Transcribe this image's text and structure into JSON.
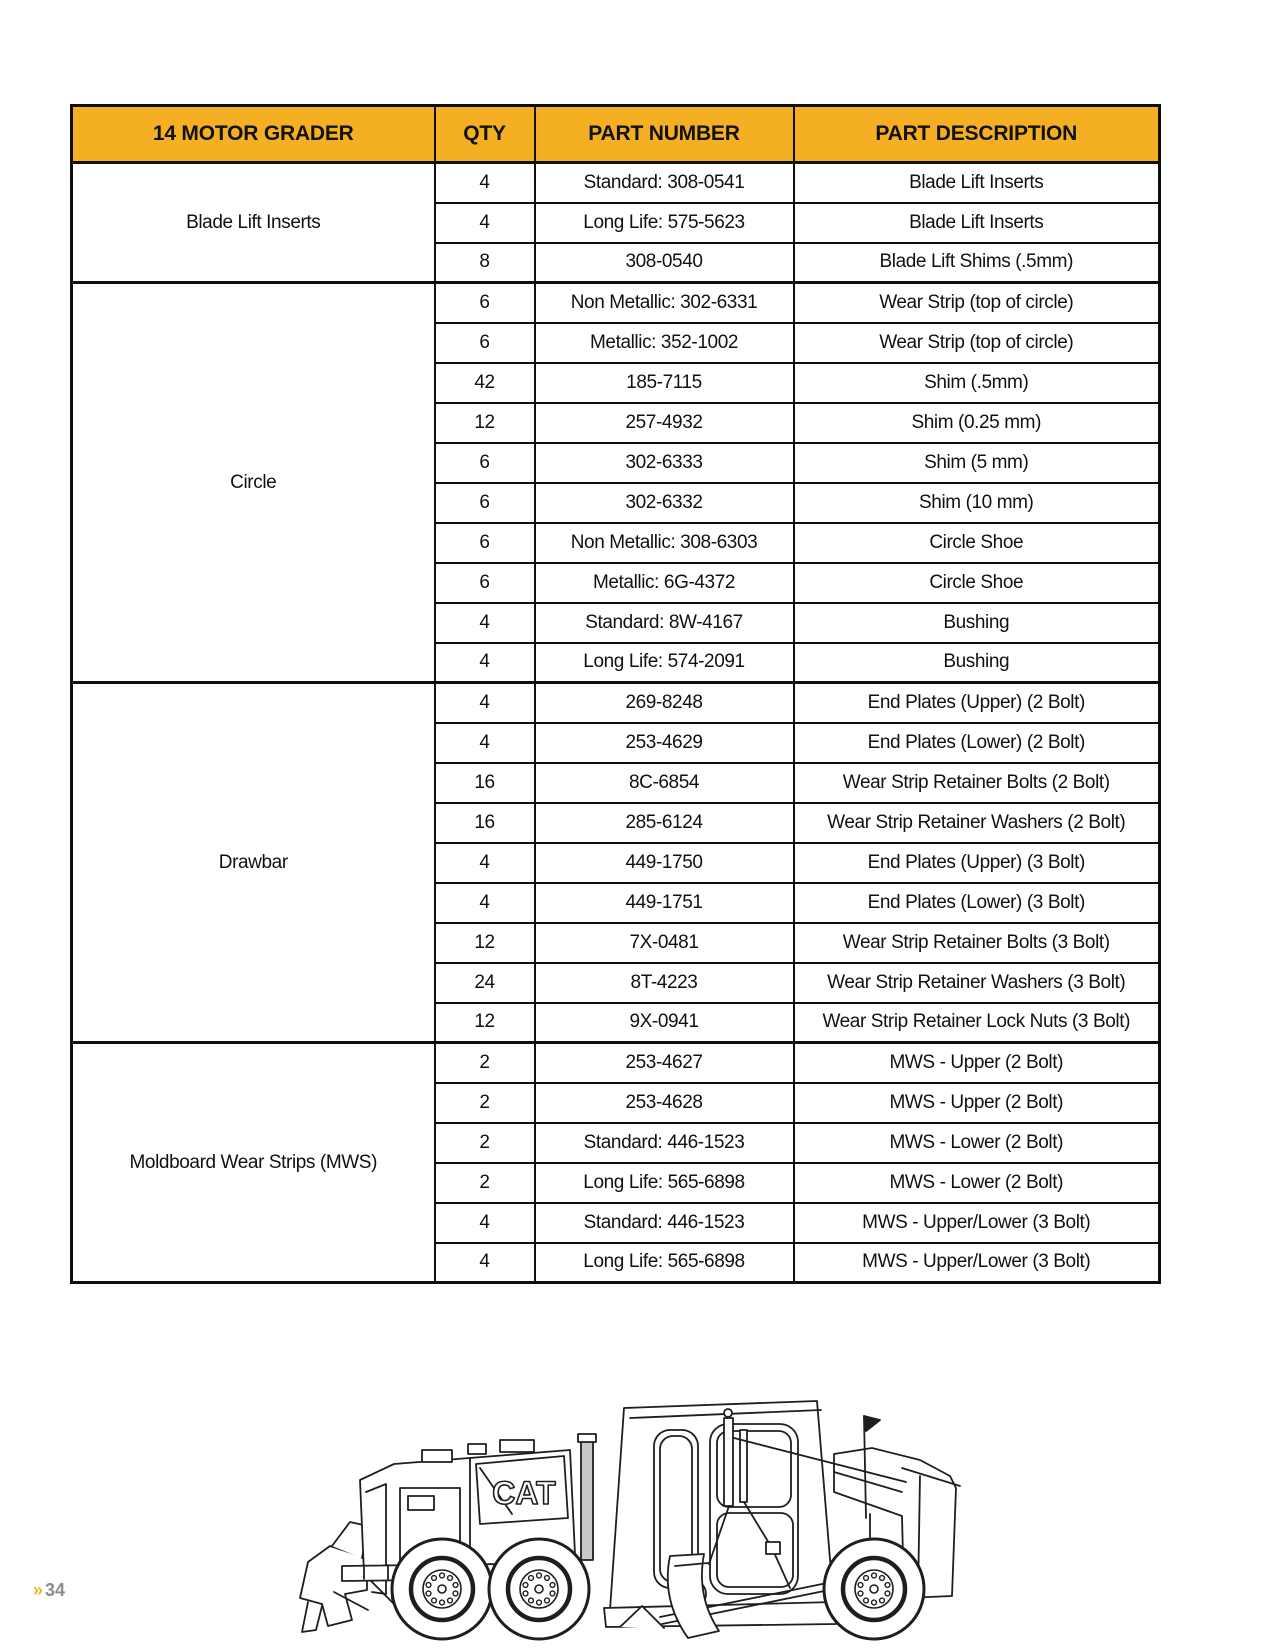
{
  "page": {
    "marker": "»",
    "number": "34"
  },
  "colors": {
    "header_bg": "#F4AF23",
    "border": "#0E0E0E",
    "marker_yellow": "#F0B429",
    "page_number_gray": "#8C8C8E"
  },
  "table": {
    "headers": [
      "14 MOTOR GRADER",
      "QTY",
      "PART NUMBER",
      "PART DESCRIPTION"
    ],
    "sections": [
      {
        "group": "Blade Lift Inserts",
        "rows": [
          {
            "qty": "4",
            "part_number": "Standard: 308-0541",
            "description": "Blade Lift Inserts"
          },
          {
            "qty": "4",
            "part_number": "Long Life: 575-5623",
            "description": "Blade Lift Inserts"
          },
          {
            "qty": "8",
            "part_number": "308-0540",
            "description": "Blade Lift Shims (.5mm)"
          }
        ]
      },
      {
        "group": "Circle",
        "rows": [
          {
            "qty": "6",
            "part_number": "Non Metallic: 302-6331",
            "description": "Wear Strip (top of circle)"
          },
          {
            "qty": "6",
            "part_number": "Metallic: 352-1002",
            "description": "Wear Strip (top of circle)"
          },
          {
            "qty": "42",
            "part_number": "185-7115",
            "description": "Shim (.5mm)"
          },
          {
            "qty": "12",
            "part_number": "257-4932",
            "description": "Shim (0.25 mm)"
          },
          {
            "qty": "6",
            "part_number": "302-6333",
            "description": "Shim (5 mm)"
          },
          {
            "qty": "6",
            "part_number": "302-6332",
            "description": "Shim (10 mm)"
          },
          {
            "qty": "6",
            "part_number": "Non Metallic: 308-6303",
            "description": "Circle Shoe"
          },
          {
            "qty": "6",
            "part_number": "Metallic: 6G-4372",
            "description": "Circle Shoe"
          },
          {
            "qty": "4",
            "part_number": "Standard: 8W-4167",
            "description": "Bushing"
          },
          {
            "qty": "4",
            "part_number": "Long Life: 574-2091",
            "description": "Bushing"
          }
        ]
      },
      {
        "group": "Drawbar",
        "rows": [
          {
            "qty": "4",
            "part_number": "269-8248",
            "description": "End Plates (Upper) (2 Bolt)"
          },
          {
            "qty": "4",
            "part_number": "253-4629",
            "description": "End Plates (Lower) (2 Bolt)"
          },
          {
            "qty": "16",
            "part_number": "8C-6854",
            "description": "Wear Strip Retainer Bolts (2 Bolt)"
          },
          {
            "qty": "16",
            "part_number": "285-6124",
            "description": "Wear Strip Retainer Washers (2 Bolt)"
          },
          {
            "qty": "4",
            "part_number": "449-1750",
            "description": "End Plates (Upper) (3 Bolt)"
          },
          {
            "qty": "4",
            "part_number": "449-1751",
            "description": "End Plates (Lower) (3 Bolt)"
          },
          {
            "qty": "12",
            "part_number": "7X-0481",
            "description": "Wear Strip Retainer Bolts (3 Bolt)"
          },
          {
            "qty": "24",
            "part_number": "8T-4223",
            "description": "Wear Strip Retainer Washers (3 Bolt)"
          },
          {
            "qty": "12",
            "part_number": "9X-0941",
            "description": "Wear Strip Retainer Lock Nuts (3 Bolt)"
          }
        ]
      },
      {
        "group": "Moldboard Wear Strips (MWS)",
        "rows": [
          {
            "qty": "2",
            "part_number": "253-4627",
            "description": "MWS - Upper (2 Bolt)"
          },
          {
            "qty": "2",
            "part_number": "253-4628",
            "description": "MWS - Upper (2 Bolt)"
          },
          {
            "qty": "2",
            "part_number": "Standard: 446-1523",
            "description": "MWS - Lower (2 Bolt)"
          },
          {
            "qty": "2",
            "part_number": "Long Life: 565-6898",
            "description": "MWS - Lower (2 Bolt)"
          },
          {
            "qty": "4",
            "part_number": "Standard: 446-1523",
            "description": "MWS - Upper/Lower (3 Bolt)"
          },
          {
            "qty": "4",
            "part_number": "Long Life: 565-6898",
            "description": "MWS - Upper/Lower (3 Bolt)"
          }
        ]
      }
    ]
  },
  "illustration": {
    "logo": "CAT"
  }
}
